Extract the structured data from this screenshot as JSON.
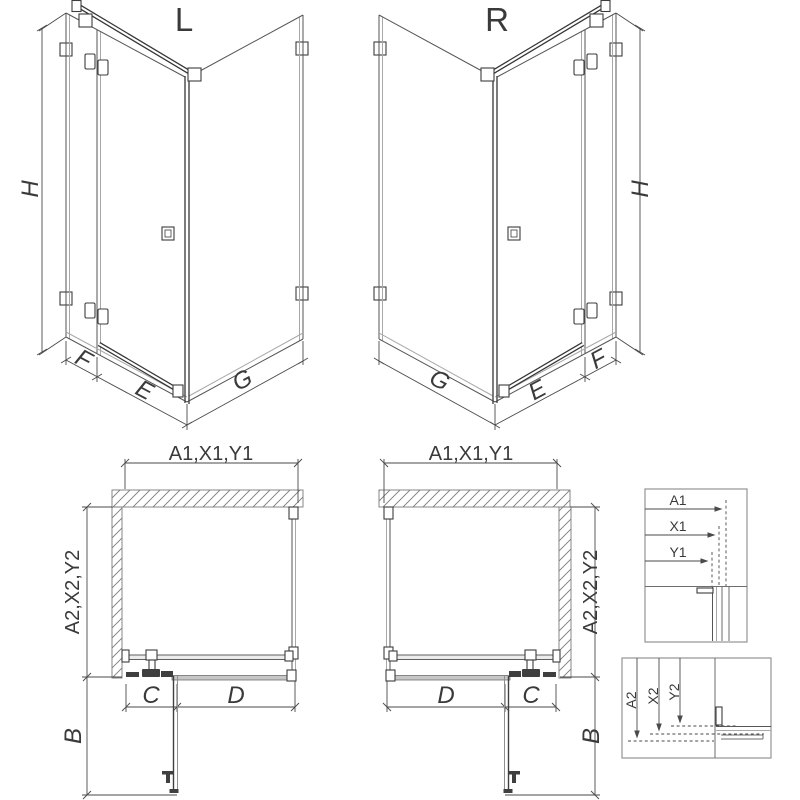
{
  "colors": {
    "line_dark": "#3f3f3f",
    "line_mid": "#6e6e6e",
    "line_gray": "#a8a8a8",
    "hatch": "#7a7a7a",
    "panel_gray": "#c6c6c6",
    "background": "#ffffff"
  },
  "iso_views": {
    "left": {
      "variant_label": "L",
      "height_dim": "H",
      "return_panel_dim": "F",
      "door_dim": "E",
      "side_panel_dim": "G"
    },
    "right": {
      "variant_label": "R",
      "height_dim": "H",
      "return_panel_dim": "F",
      "door_dim": "E",
      "side_panel_dim": "G"
    }
  },
  "plan_views": {
    "left": {
      "width_dim": "A1,X1,Y1",
      "depth_dim": "A2,X2,Y2",
      "door_dim": "C",
      "fixed_dim": "D",
      "swing_dim": "B"
    },
    "right": {
      "width_dim": "A1,X1,Y1",
      "depth_dim": "A2,X2,Y2",
      "door_dim": "C",
      "fixed_dim": "D",
      "swing_dim": "B"
    }
  },
  "detail_views": {
    "width": {
      "labels": [
        "A1",
        "X1",
        "Y1"
      ]
    },
    "depth": {
      "labels": [
        "A2",
        "X2",
        "Y2"
      ]
    }
  }
}
